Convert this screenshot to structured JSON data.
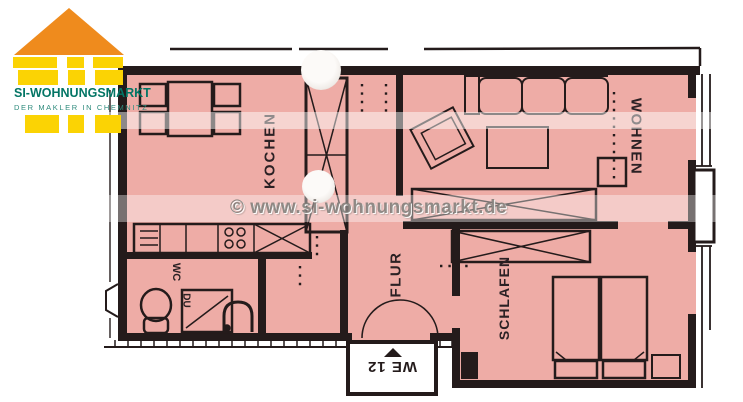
{
  "logo": {
    "company": "SI-WOHNUNGSMARKT",
    "tagline": "DER MAKLER IN CHEMNITZ",
    "colors": {
      "roof": "#ef8b1d",
      "blocks": "#fbd304",
      "text": "#037565"
    }
  },
  "watermark": {
    "text": "© www.si-wohnungsmarkt.de"
  },
  "plan": {
    "unit_label": "WE 12",
    "rooms": {
      "kitchen": "KOCHEN",
      "living": "WOHNEN",
      "hall": "FLUR",
      "bedroom": "SCHLAFEN",
      "wc": "WC",
      "shower": "DU"
    },
    "colors": {
      "floor": "#eeaca6",
      "walls": "#241b1b"
    }
  }
}
